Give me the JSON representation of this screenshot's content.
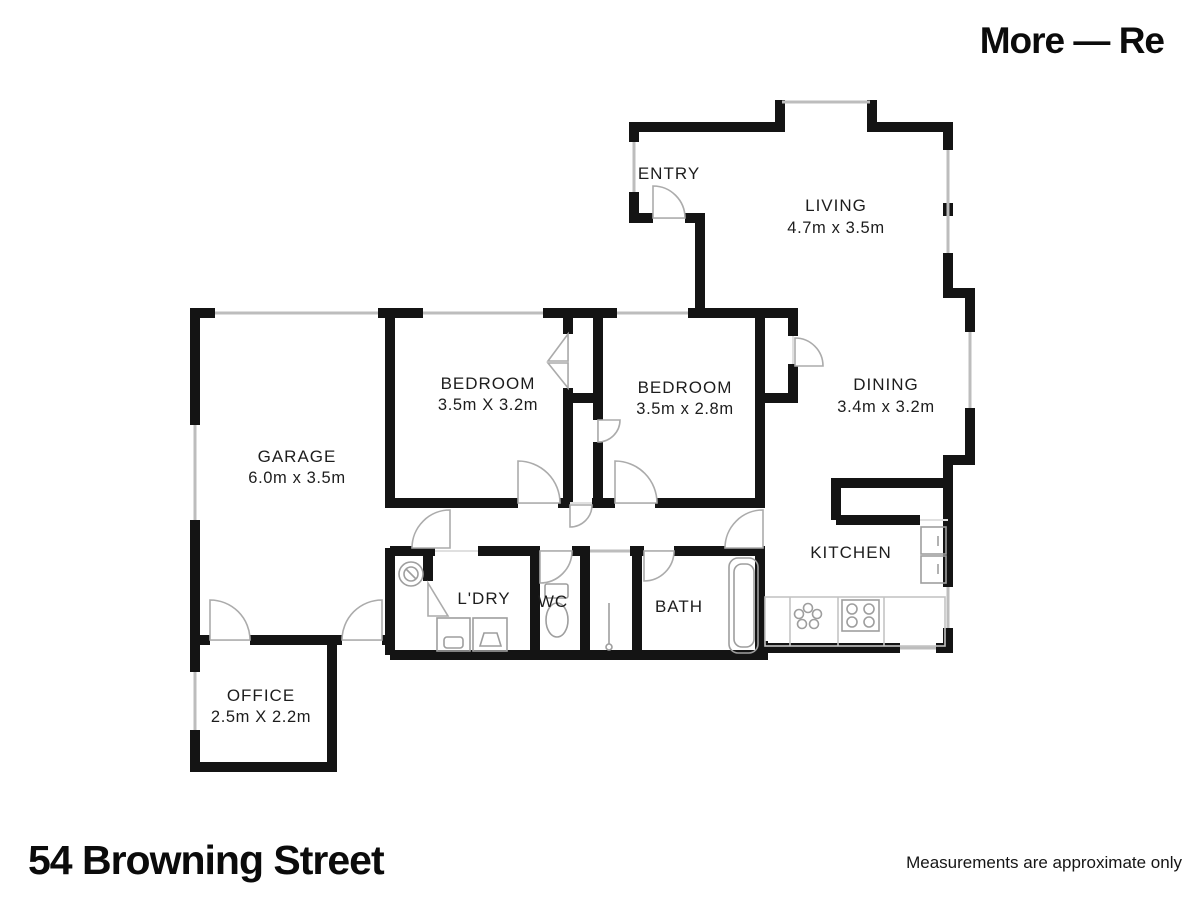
{
  "brand": "More — Re",
  "address": "54 Browning Street",
  "disclaimer": "Measurements are approximate only",
  "rooms": {
    "entry": {
      "name": "ENTRY",
      "dims": ""
    },
    "living": {
      "name": "LIVING",
      "dims": "4.7m x 3.5m"
    },
    "dining": {
      "name": "DINING",
      "dims": "3.4m x 3.2m"
    },
    "bedroom1": {
      "name": "BEDROOM",
      "dims": "3.5m X 3.2m"
    },
    "bedroom2": {
      "name": "BEDROOM",
      "dims": "3.5m x 2.8m"
    },
    "garage": {
      "name": "GARAGE",
      "dims": "6.0m x 3.5m"
    },
    "kitchen": {
      "name": "KITCHEN",
      "dims": ""
    },
    "laundry": {
      "name": "L'DRY",
      "dims": ""
    },
    "wc": {
      "name": "WC",
      "dims": ""
    },
    "bath": {
      "name": "BATH",
      "dims": ""
    },
    "office": {
      "name": "OFFICE",
      "dims": "2.5m X 2.2m"
    }
  },
  "colors": {
    "wall": "#141414",
    "window": "#bdbdbd",
    "door": "#ababab",
    "fixture": "#9e9e9e"
  }
}
